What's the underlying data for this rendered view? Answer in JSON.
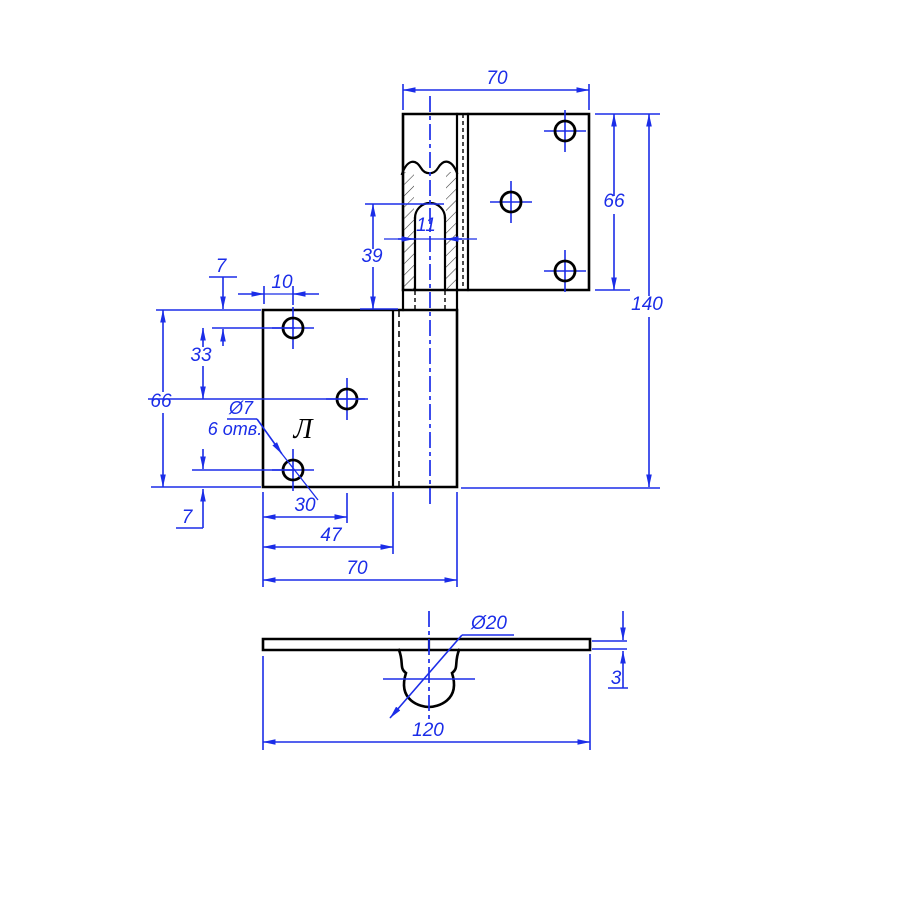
{
  "drawing": {
    "type": "hinge technical drawing",
    "colors": {
      "outline": "#000000",
      "dimension": "#1b2de8",
      "background": "#ffffff"
    },
    "dims": {
      "top_width": "70",
      "plate_height": "66",
      "total_height": "140",
      "knuckle_offset": "39",
      "pin_slot": "11",
      "hole_edge_top": "7",
      "hole_edge_side": "10",
      "hole_spacing": "33",
      "left_plate_height": "66",
      "hole_edge_bottom": "7",
      "hole_x_near": "30",
      "hole_x_far": "47",
      "left_plate_width": "70",
      "total_length": "120",
      "thickness": "3"
    },
    "notes": {
      "hole_diameter": "Ø7",
      "hole_count": "6 отв.",
      "knuckle_diameter": "Ø20",
      "part_side": "Л"
    }
  }
}
